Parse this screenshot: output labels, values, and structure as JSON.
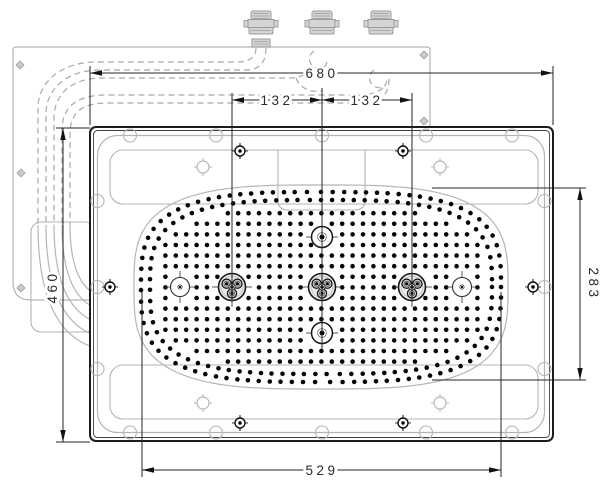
{
  "title": "overhead-shower-panel-technical-drawing",
  "canvas": {
    "width": 600,
    "height": 489,
    "background": "#ffffff"
  },
  "colors": {
    "dark": "#1c1c1c",
    "inner_edge": "#3f3f3f",
    "dim_line": "#262626",
    "light": "#b5b5b5",
    "metal_fill": "#d5d5d5",
    "metal_stroke": "#9a9a9a",
    "diamond_fill": "#cccccc",
    "dot": "#060606",
    "jet_face": "#e8e8e8",
    "jet_sub": "#cfcfcf"
  },
  "installation": {
    "outline_path": "M 430 127 L 430 50 Q 430 47 427 47 L 16 47 Q 13 47 13 50 L 13 282 Q 13 300 31 300 L 90 300",
    "guide_box": {
      "x": 31,
      "y": 222,
      "w": 64,
      "h": 110,
      "r": 10
    },
    "diamond_screws": [
      [
        20,
        65
      ],
      [
        21,
        173
      ],
      [
        21,
        288
      ],
      [
        424,
        55
      ],
      [
        424,
        121
      ]
    ],
    "diamond_size": 5.6
  },
  "connectors": {
    "centers_x": [
      261,
      322,
      381
    ],
    "stub_center_x": 261
  },
  "hoses": {
    "dash": "6 4",
    "dashed_paths": [
      "M 256 48 C 256 58 248 62 238 62 L 96 62 C 64 62 38 80 38 108 L 38 225",
      "M 266 48 C 266 64 258 70 246 70 L 100 70 C 68 70 46 88 46 114 L 46 225",
      "M 314 51 C 308 55 308 63 314 67 C 320 71 327 68 327 60",
      "M 312 68 C 302 80 290 78 276 78 L 102 78 C 72 78 54 94 54 118 L 54 225",
      "M 296 78 C 300 88 310 93 322 91",
      "M 374 70 C 368 74 368 82 374 86 C 380 90 387 87 387 79",
      "M 383 88 C 371 97 357 95 343 95 L 106 95 C 78 95 62 106 62 130 L 62 225",
      "M 389 79 C 389 99 376 103 360 103 L 108 103 C 82 103 70 112 70 134 L 70 225"
    ],
    "solid_paths": [
      "M 38 225 C 38 298 58 342 104 350",
      "M 46 225 C 46 290 64 330 104 338",
      "M 54 225 C 54 283 70 318 104 324",
      "M 62 225 C 62 276 76 306 104 310",
      "M 70 225 C 70 268 82 294 104 296"
    ]
  },
  "panel": {
    "x": 90,
    "y": 127,
    "w": 463,
    "h": 314,
    "corner": 6,
    "inner_edge": {
      "x": 93.5,
      "y": 130.5,
      "w": 456,
      "h": 307,
      "r": 4
    },
    "inner_outline": {
      "x": 97.5,
      "y": 135.5,
      "w": 447,
      "h": 297,
      "r": 20
    },
    "bands": [
      {
        "x": 110,
        "y": 150,
        "w": 428,
        "h": 54,
        "r": 13
      },
      {
        "x": 110,
        "y": 365,
        "w": 428,
        "h": 54,
        "r": 13
      }
    ],
    "center_box_path": "M 278 150 L 278 200 Q 278 210 288 210 L 355 210 Q 365 210 365 200 L 365 150",
    "notches": {
      "r": 6.5,
      "top_y": 135.5,
      "bottom_y": 432.5,
      "left_x": 97.5,
      "right_x": 544.5,
      "xs": [
        130,
        216,
        322,
        426,
        512
      ],
      "ys": [
        201,
        287,
        369
      ]
    },
    "light_screws": [
      [
        203,
        167
      ],
      [
        440,
        167
      ],
      [
        203,
        403
      ],
      [
        440,
        403
      ]
    ],
    "black_screws": [
      [
        240,
        151
      ],
      [
        403,
        151
      ],
      [
        110,
        287
      ],
      [
        533,
        287
      ],
      [
        240,
        423
      ],
      [
        403,
        423
      ]
    ]
  },
  "spray_field": {
    "cx": 321,
    "cy": 287,
    "rx": 187,
    "ry": 102,
    "exponent": 3.2,
    "dot_radius": 2.3,
    "rings": [
      {
        "rx": 180,
        "ry": 95
      },
      {
        "rx": 171,
        "ry": 87
      }
    ],
    "ring_spacing": 10.4,
    "grid": {
      "x_start": 155,
      "x_end": 488,
      "x_step": 10.4,
      "y_start": 192,
      "y_end": 383,
      "y_step": 10.6,
      "rx": 164,
      "ry": 79
    },
    "fixtures": {
      "large_jets": [
        [
          232,
          287
        ],
        [
          322,
          287
        ],
        [
          412,
          287
        ]
      ],
      "small_jets": [
        [
          180,
          287
        ],
        [
          462,
          287
        ]
      ],
      "cross_nozzles": [
        [
          322,
          237
        ],
        [
          322,
          333
        ]
      ],
      "clear_large": 17,
      "clear_small": 13.5
    }
  },
  "dimensions": {
    "labels": {
      "overall_width": "680",
      "jet_spacing_left": "132",
      "jet_spacing_right": "132",
      "overall_height": "460",
      "field_height": "283",
      "field_width": "529"
    },
    "horizontal": [
      {
        "name": "overall-width",
        "label_key": "overall_width",
        "y": 73,
        "x1": 90,
        "x2": 553,
        "label_x": 322,
        "ext": [
          [
            90,
            66,
            125
          ],
          [
            553,
            66,
            125
          ]
        ]
      },
      {
        "name": "jet-spacing-left",
        "label_key": "jet_spacing_left",
        "y": 100,
        "x1": 232,
        "x2": 322,
        "label_x": 277,
        "ext": [
          [
            232,
            93,
            302
          ],
          [
            322,
            88,
            348
          ],
          [
            412,
            93,
            302
          ]
        ]
      },
      {
        "name": "jet-spacing-right",
        "label_key": "jet_spacing_right",
        "y": 100,
        "x1": 322,
        "x2": 412,
        "label_x": 367,
        "ext": []
      },
      {
        "name": "field-width",
        "label_key": "field_width",
        "y": 470,
        "x1": 142,
        "x2": 501,
        "label_x": 322,
        "ext": [
          [
            142,
            292,
            477
          ],
          [
            501,
            292,
            477
          ]
        ]
      }
    ],
    "vertical": [
      {
        "name": "overall-height",
        "label_key": "overall_height",
        "x": 63,
        "y1": 128,
        "y2": 442,
        "label_y": 287,
        "rotate": -90,
        "label_offset": -6,
        "ext": [
          [
            128,
            56,
            90
          ],
          [
            442,
            56,
            90
          ]
        ]
      },
      {
        "name": "field-height",
        "label_key": "field_height",
        "x": 580,
        "y1": 188,
        "y2": 380,
        "label_y": 284,
        "rotate": 90,
        "label_offset": 9,
        "ext": [
          [
            188,
            432,
            586
          ],
          [
            380,
            432,
            586
          ]
        ]
      }
    ]
  }
}
